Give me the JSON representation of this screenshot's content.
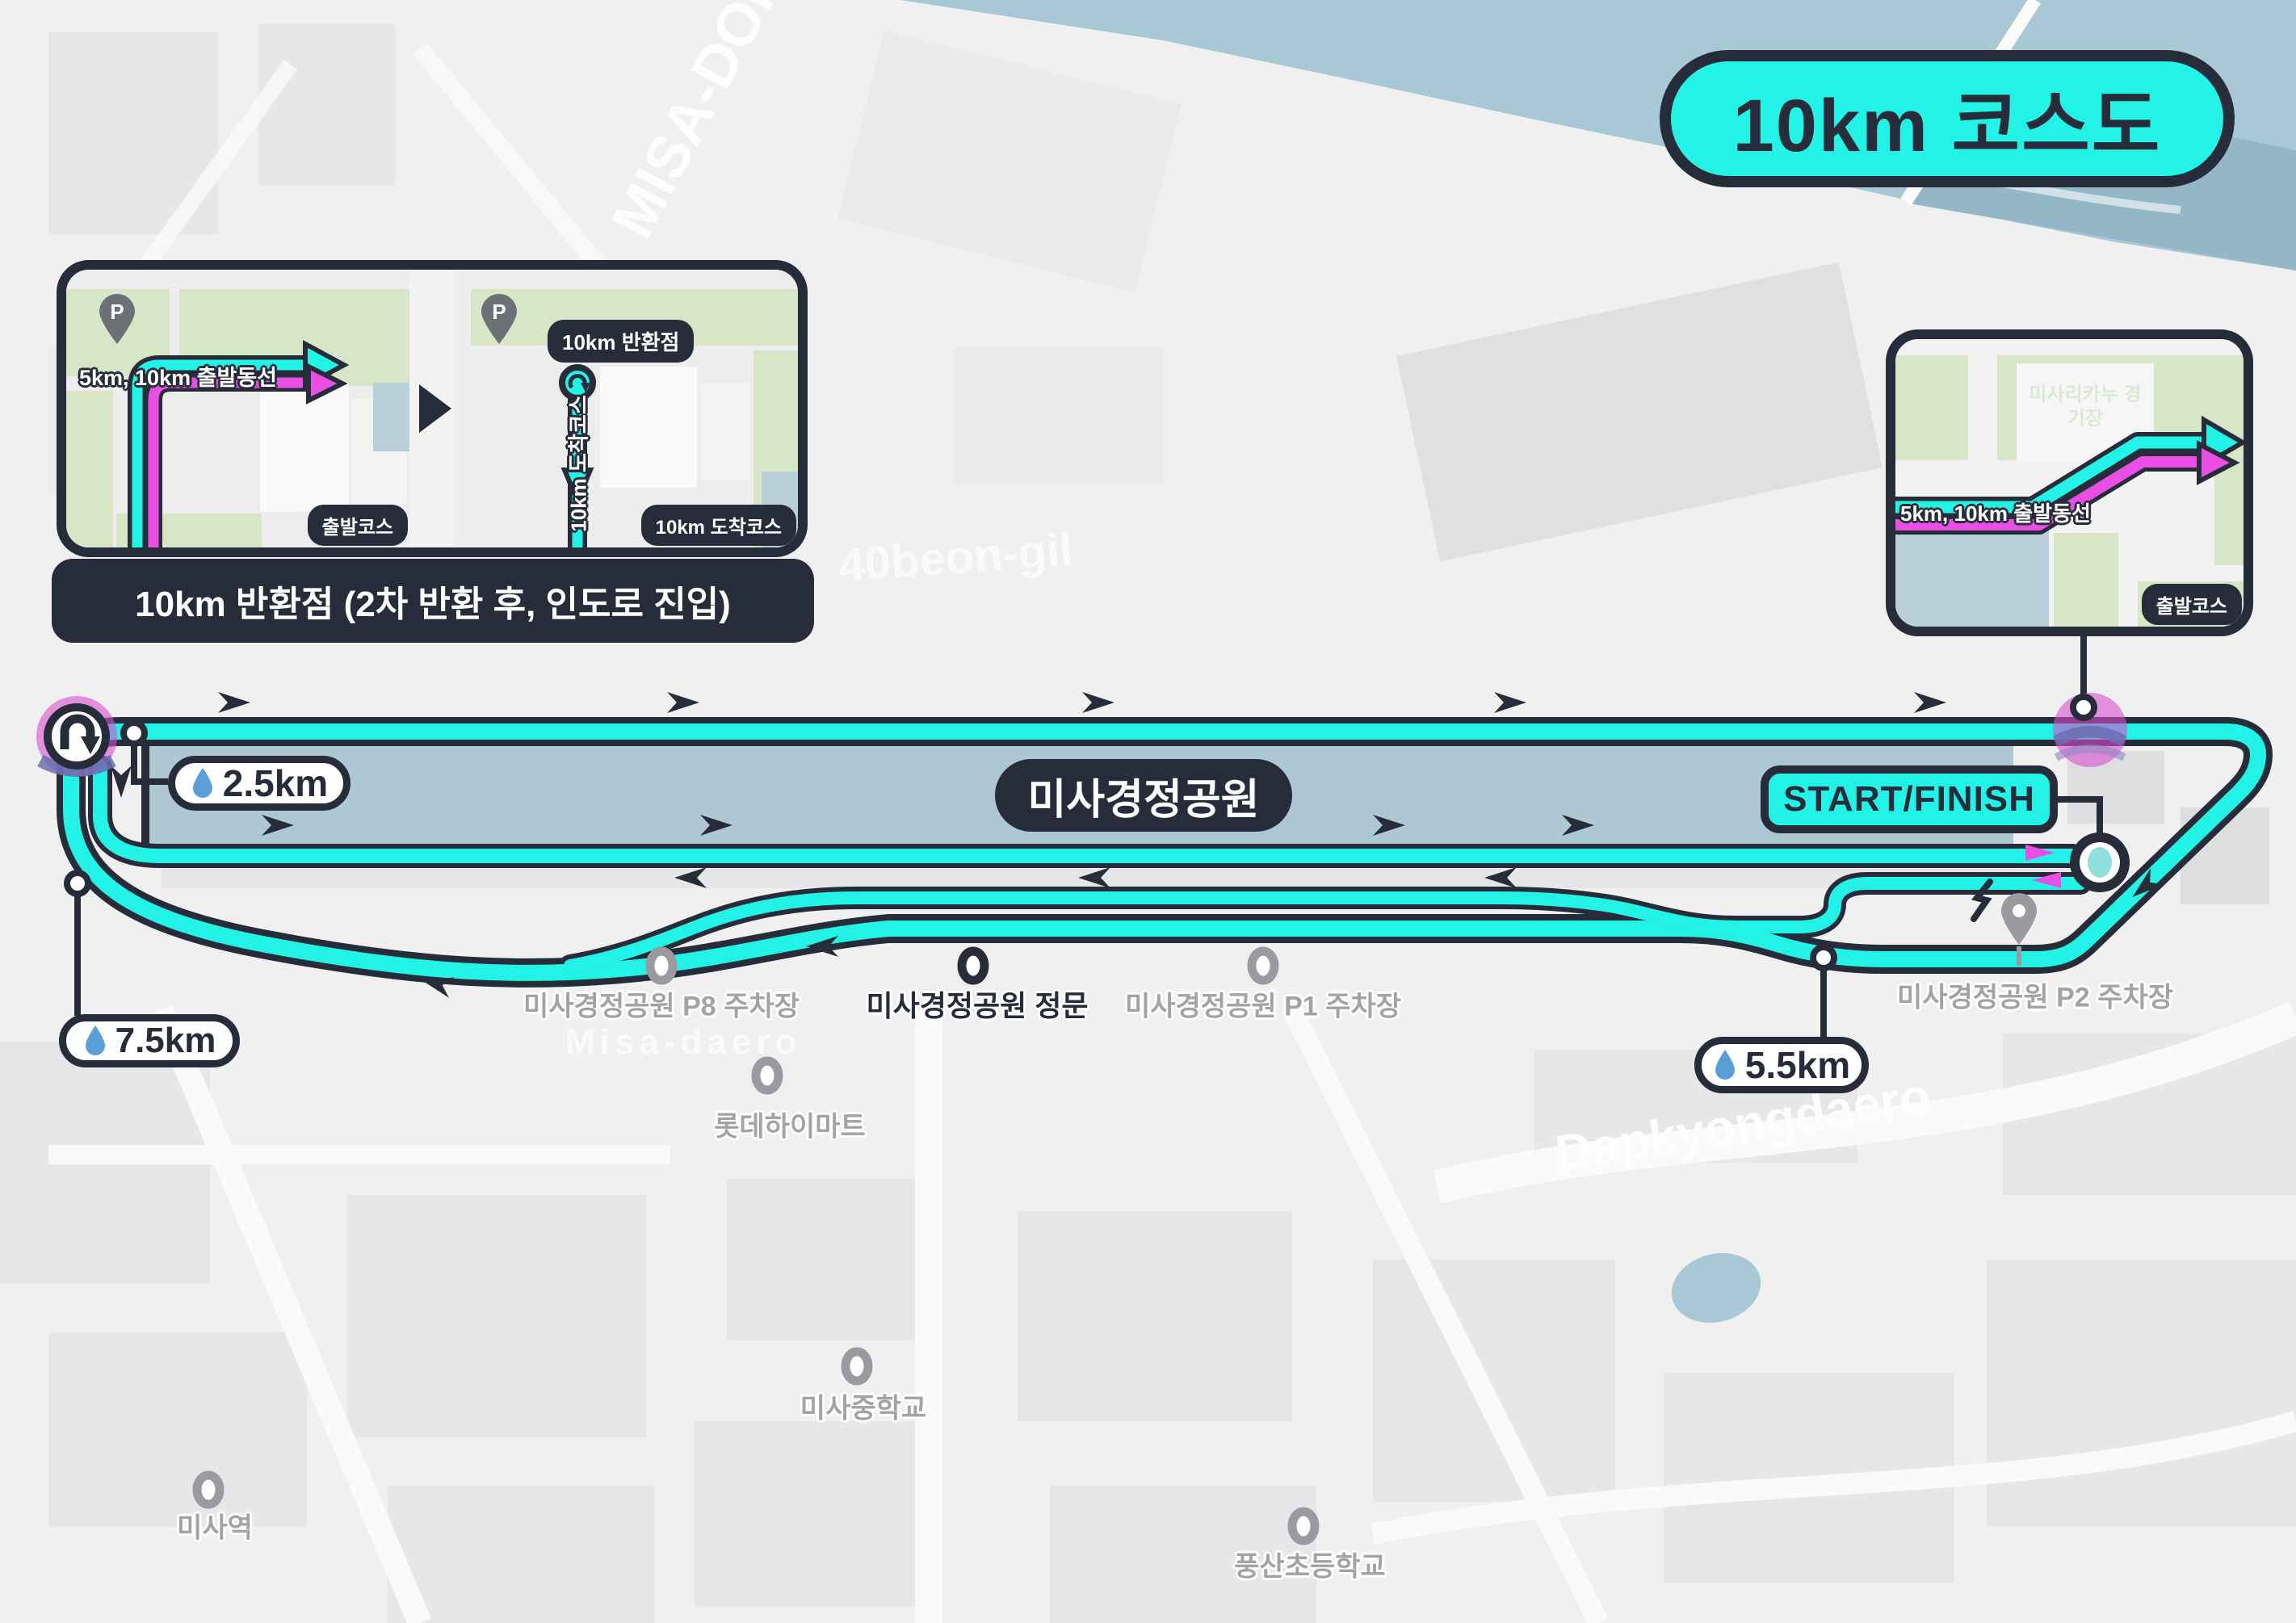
{
  "title": {
    "label": "10km 코스도"
  },
  "course": {
    "park_label": "미사경정공원",
    "start_finish_label": "START/FINISH",
    "stations": [
      {
        "label": "2.5km"
      },
      {
        "label": "7.5km"
      },
      {
        "label": "5.5km"
      }
    ]
  },
  "inset_turnaround": {
    "caption": "10km 반환점 (2차 반환 후, 인도로 진입)",
    "left_panel": {
      "route_label": "5km, 10km 출발동선",
      "corner_badge": "출발코스",
      "pin_letter": "P"
    },
    "right_panel": {
      "top_badge": "10km 반환점",
      "route_label": "10km 도착코스",
      "corner_badge": "10km 도착코스",
      "pin_letter": "P"
    }
  },
  "inset_start": {
    "route_label": "5km, 10km 출발동선",
    "corner_badge": "출발코스",
    "building_label": "미사리카누 경기장"
  },
  "map_labels": {
    "p8": "미사경정공원 P8 주차장",
    "gate": "미사경정공원 정문",
    "p1": "미사경정공원 P1 주차장",
    "p2": "미사경정공원 P2 주차장",
    "himart": "롯데하이마트",
    "middle_school": "미사중학교",
    "station": "미사역",
    "elementary": "풍산초등학교"
  },
  "watermarks": {
    "district": "MISA-DONG",
    "district_kr": "미사동",
    "road_40": "40beon-gil",
    "road_misa": "Misa-daero",
    "road_far": "Dapkyongdaero"
  },
  "colors": {
    "cyan": "#23f2e6",
    "magenta": "#ea4fe5",
    "dark": "#272c3a",
    "park": "#adc8d3",
    "water": "#a9c8d5",
    "drop": "#5b9fd8"
  }
}
